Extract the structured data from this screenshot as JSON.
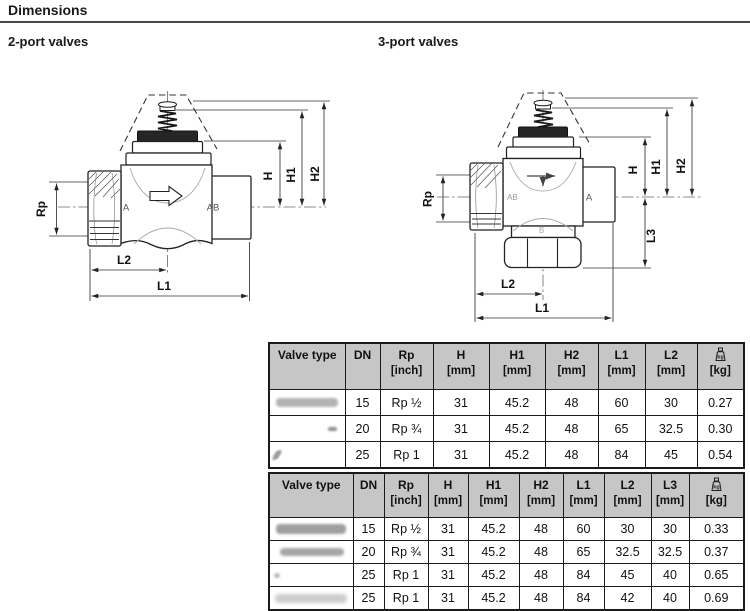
{
  "header": {
    "title": "Dimensions"
  },
  "sections": {
    "two_port_title": "2-port valves",
    "three_port_title": "3-port valves"
  },
  "diagram2": {
    "rp": "Rp",
    "a": "A",
    "ab": "AB",
    "h": "H",
    "h1": "H1",
    "h2": "H2",
    "l2": "L2",
    "l1": "L1"
  },
  "diagram3": {
    "rp": "Rp",
    "ab": "AB",
    "a": "A",
    "b": "B",
    "h": "H",
    "h1": "H1",
    "h2": "H2",
    "l3": "L3",
    "l2": "L2",
    "l1": "L1"
  },
  "table_2port": {
    "col_headers": [
      {
        "label": "Valve type",
        "unit": ""
      },
      {
        "label": "DN",
        "unit": ""
      },
      {
        "label": "Rp",
        "unit": "[inch]"
      },
      {
        "label": "H",
        "unit": "[mm]"
      },
      {
        "label": "H1",
        "unit": "[mm]"
      },
      {
        "label": "H2",
        "unit": "[mm]"
      },
      {
        "label": "L1",
        "unit": "[mm]"
      },
      {
        "label": "L2",
        "unit": "[mm]"
      },
      {
        "label": "",
        "icon": "weight-icon",
        "unit": "[kg]"
      }
    ],
    "rows": [
      [
        "",
        "15",
        "Rp ½",
        "31",
        "45.2",
        "48",
        "60",
        "30",
        "0.27"
      ],
      [
        "",
        "20",
        "Rp ¾",
        "31",
        "45.2",
        "48",
        "65",
        "32.5",
        "0.30"
      ],
      [
        "",
        "25",
        "Rp 1",
        "31",
        "45.2",
        "48",
        "84",
        "45",
        "0.54"
      ]
    ]
  },
  "table_3port": {
    "col_headers": [
      {
        "label": "Valve type",
        "unit": ""
      },
      {
        "label": "DN",
        "unit": ""
      },
      {
        "label": "Rp",
        "unit": "[inch]"
      },
      {
        "label": "H",
        "unit": "[mm]"
      },
      {
        "label": "H1",
        "unit": "[mm]"
      },
      {
        "label": "H2",
        "unit": "[mm]"
      },
      {
        "label": "L1",
        "unit": "[mm]"
      },
      {
        "label": "L2",
        "unit": "[mm]"
      },
      {
        "label": "L3",
        "unit": "[mm]"
      },
      {
        "label": "",
        "icon": "weight-icon",
        "unit": "[kg]"
      }
    ],
    "rows": [
      [
        "",
        "15",
        "Rp ½",
        "31",
        "45.2",
        "48",
        "60",
        "30",
        "30",
        "0.33"
      ],
      [
        "",
        "20",
        "Rp ¾",
        "31",
        "45.2",
        "48",
        "65",
        "32.5",
        "32.5",
        "0.37"
      ],
      [
        "",
        "25",
        "Rp 1",
        "31",
        "45.2",
        "48",
        "84",
        "45",
        "40",
        "0.65"
      ],
      [
        "",
        "25",
        "Rp 1",
        "31",
        "45.2",
        "48",
        "84",
        "42",
        "40",
        "0.69"
      ]
    ]
  }
}
